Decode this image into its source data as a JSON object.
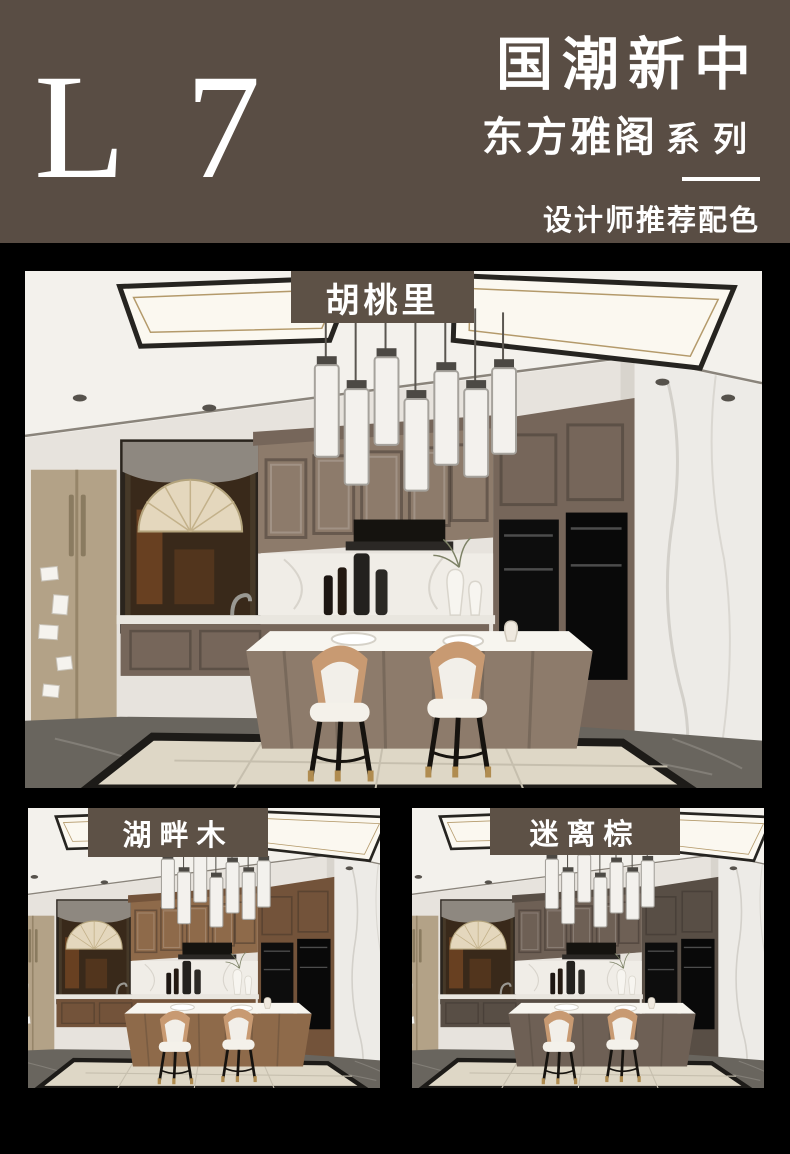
{
  "page": {
    "background_color": "#000000"
  },
  "header": {
    "background_color": "#594d44",
    "text_color": "#ffffff",
    "model_code": "L 7",
    "title": "国潮新中",
    "series_name": "东方雅阁",
    "series_suffix": "系列",
    "tagline": "设计师推荐配色"
  },
  "gallery": {
    "badge_color": "#5d5146",
    "items": [
      {
        "label": "胡桃里",
        "wood_color": "#8d7b6b",
        "wood_dark_color": "#76665a"
      },
      {
        "label": "湖畔木",
        "wood_color": "#8e6a4a",
        "wood_dark_color": "#73533a"
      },
      {
        "label": "迷离棕",
        "wood_color": "#6e6055",
        "wood_dark_color": "#584e45"
      }
    ]
  }
}
